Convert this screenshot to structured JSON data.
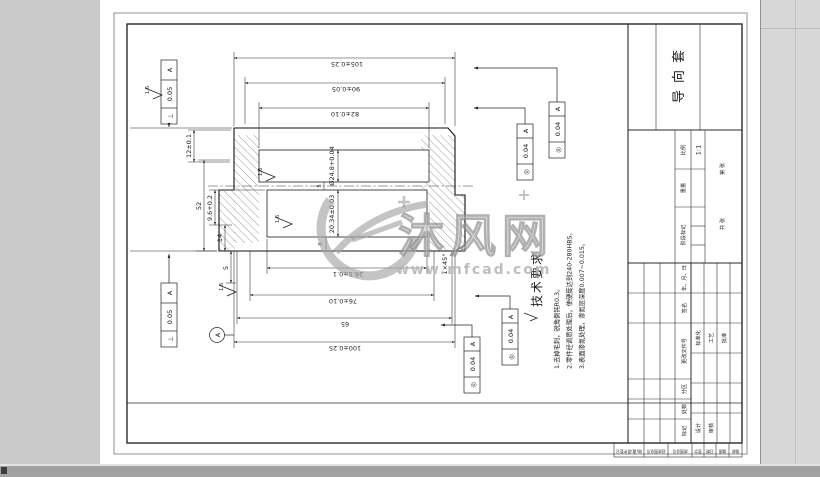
{
  "watermark": {
    "brand": "沐风网",
    "url": "www.mfcad.com"
  },
  "title_block": {
    "part_name": "导向套",
    "scale_value": "1:1",
    "labels": {
      "mark": "标记",
      "count": "处数",
      "zone": "分区",
      "change_file": "更改文件号",
      "sign": "签名",
      "date": "年、月、日",
      "design": "设计",
      "check": "审核",
      "standard": "标准化",
      "process": "工艺",
      "approve": "批准",
      "stage": "阶段标记",
      "weight": "重量",
      "scale": "比例",
      "total": "共  张",
      "page": "第  张"
    }
  },
  "margin_blocks": [
    "借(通)用件登记",
    "旧底图总号",
    "底图总号",
    "签字",
    "日期",
    "描图",
    "描校"
  ],
  "tech_req": {
    "title": "技术要求",
    "items": [
      "1.去掉毛刺，锐角倒钝R0.3。",
      "2.零件经调质处理后，使硬度达到240-280HBS。",
      "3.表面渗氮处理，渗氮层深度0.007~0.015。"
    ]
  },
  "dims": {
    "len105": "105±0.25",
    "len90": "90±0.05",
    "len82": "82±0.10",
    "len100": "100±0.25",
    "len76": "76±0.10",
    "len65": "65",
    "len26_5": "26.5±0.1",
    "w12": "12±0.1",
    "w52": "52",
    "w9_6": "9.6+0.2",
    "w14": "14",
    "w5": "5",
    "bore_large": "Ø24.8+0.04",
    "bore_small": "20.34±0.03",
    "step5": "5",
    "step6": "6",
    "chamfer": "1×45°"
  },
  "rough": {
    "v": "1.6"
  },
  "fcf": {
    "perp": "⊥",
    "conc": "◎",
    "t05": "0.05",
    "t04": "0.04",
    "datum": "A"
  }
}
